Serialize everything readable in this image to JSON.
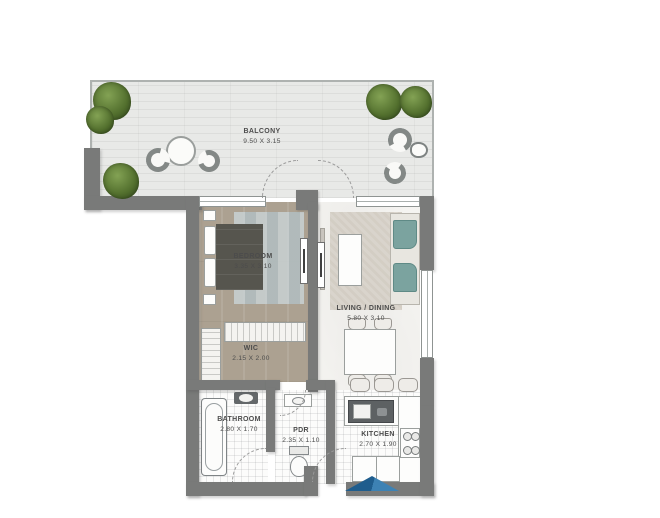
{
  "plan_title": "apartment-floor-plan",
  "rooms": {
    "balcony": {
      "name": "BALCONY",
      "dims": "9.50 X 3.15"
    },
    "bedroom": {
      "name": "BEDROOM",
      "dims": "3.35 X 3.10"
    },
    "living_dining": {
      "name": "LIVING / DINING",
      "dims": "5.80 X 3.10"
    },
    "wic": {
      "name": "WIC",
      "dims": "2.15 X 2.00"
    },
    "bathroom": {
      "name": "BATHROOM",
      "dims": "2.80 X 1.70"
    },
    "pdr": {
      "name": "PDR",
      "dims": "2.35 X 1.10"
    },
    "kitchen": {
      "name": "KITCHEN",
      "dims": "2.70 X 1.90"
    }
  },
  "colors": {
    "wall": "#797a79",
    "balcony_floor": "#e8e9e7",
    "bedroom_floor": "#aca191",
    "bedroom_rug": "#bcc7ca",
    "sofa_cushion": "#7ba39f",
    "plant_green": "#53702e",
    "entry_arrow_dark": "#1f5d8d",
    "entry_arrow_light": "#3d82b4",
    "label_text": "#4c4c4c"
  }
}
